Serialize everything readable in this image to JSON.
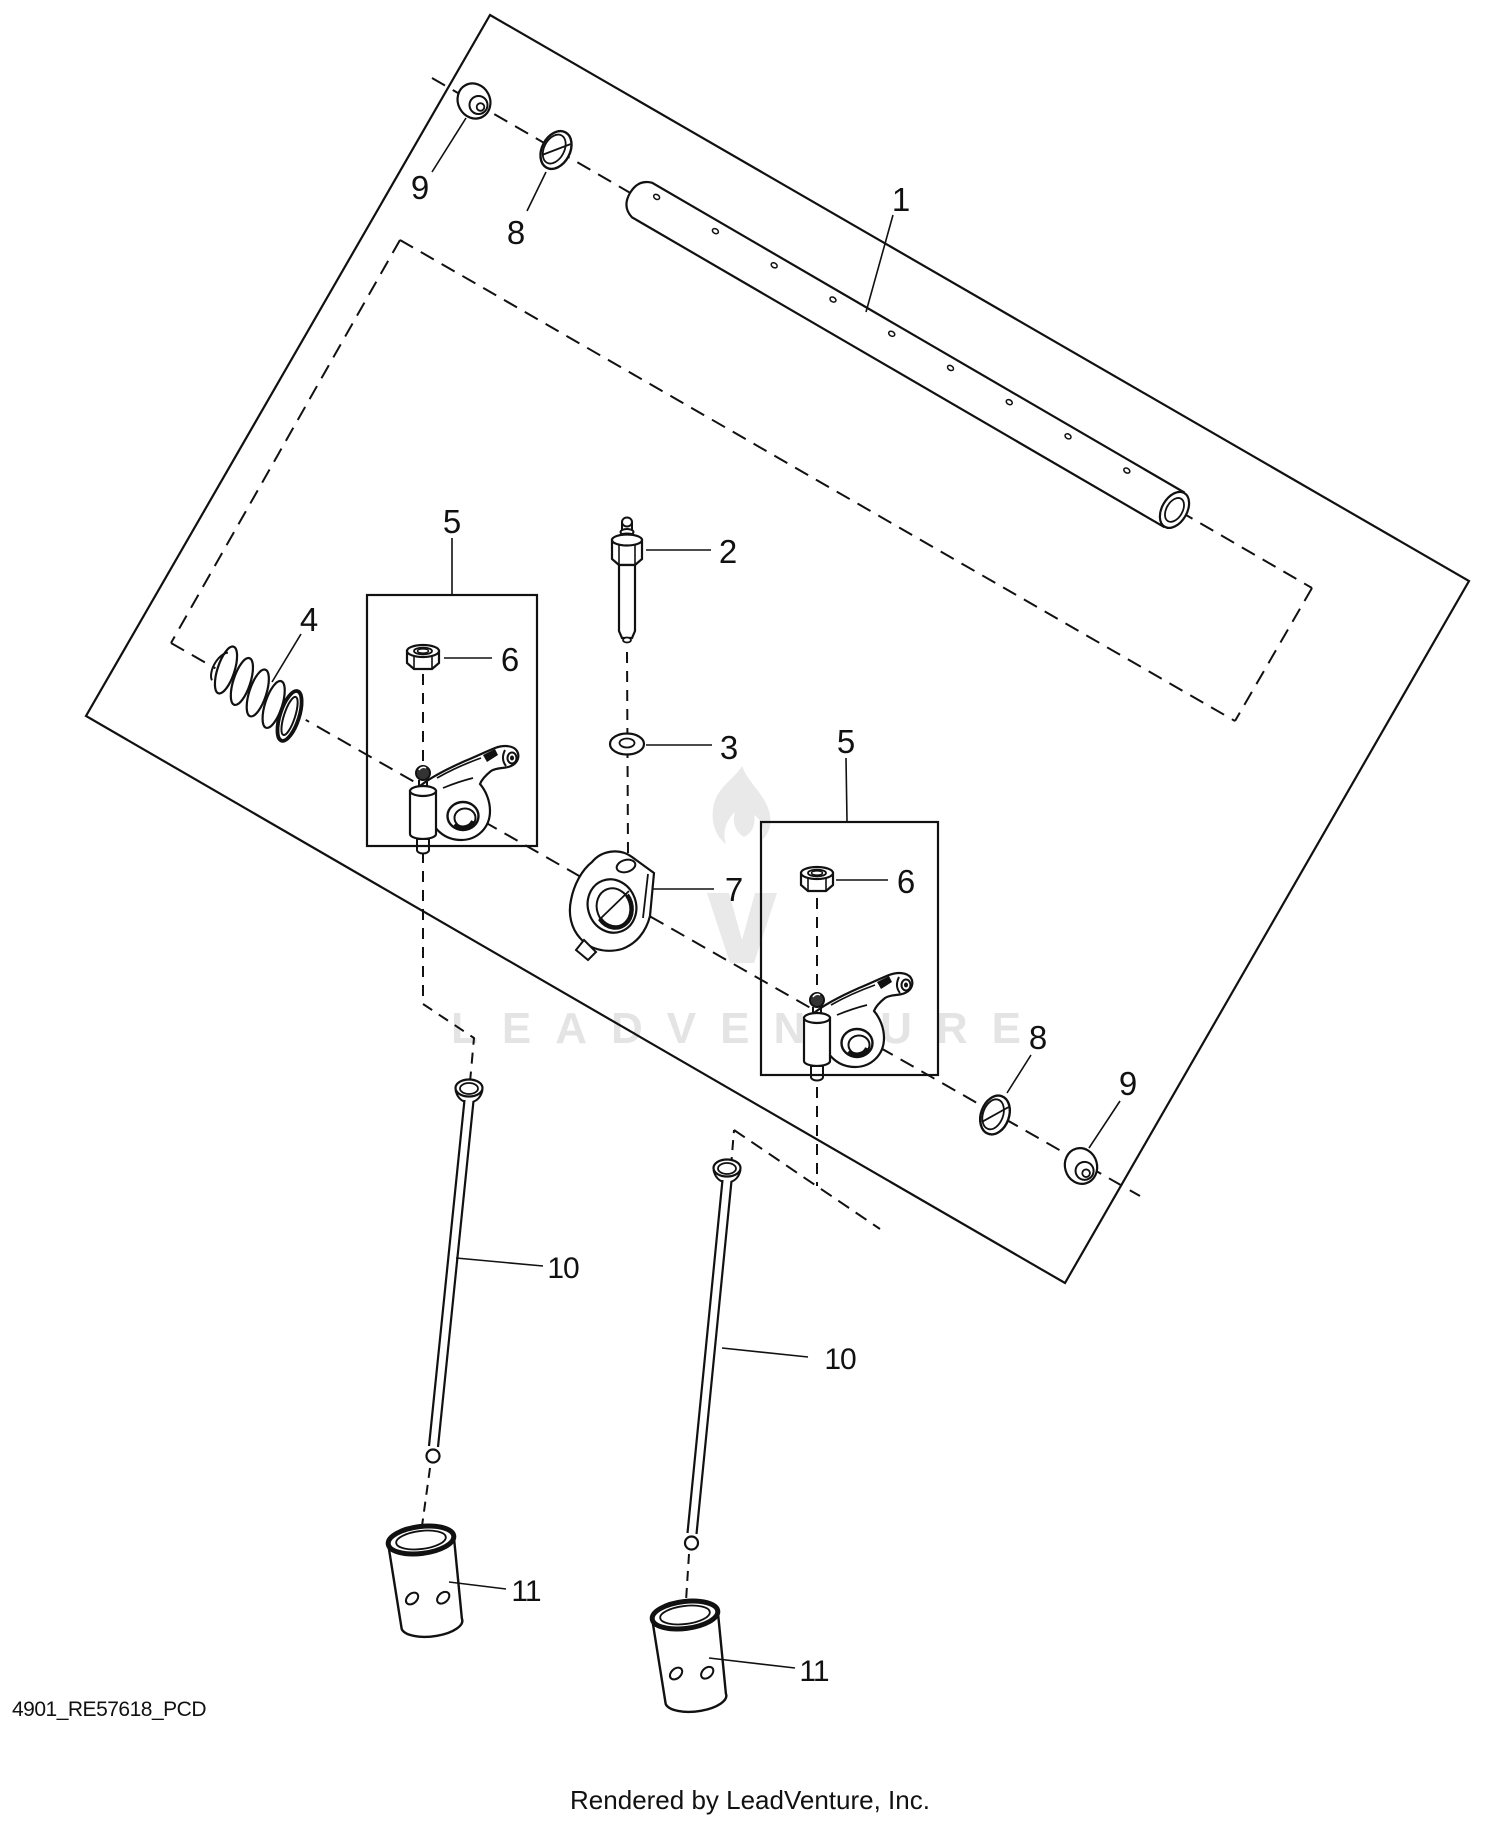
{
  "file_code": "4901_RE57618_PCD",
  "footer": "Rendered by LeadVenture, Inc.",
  "watermark": "LEADVENTURE",
  "line_color": "#111111",
  "watermark_color": "#e4e4e4",
  "callouts": [
    {
      "part": "rocker-arm-shaft",
      "text": "1"
    },
    {
      "part": "stud",
      "text": "2"
    },
    {
      "part": "washer-flat",
      "text": "3"
    },
    {
      "part": "spring",
      "text": "4"
    },
    {
      "part": "rocker-arm-assembly-left",
      "text": "5"
    },
    {
      "part": "rocker-arm-assembly-right",
      "text": "5"
    },
    {
      "part": "nut-left",
      "text": "6"
    },
    {
      "part": "nut-right",
      "text": "6"
    },
    {
      "part": "pivot-support",
      "text": "7"
    },
    {
      "part": "cup-washer-top",
      "text": "8"
    },
    {
      "part": "cup-washer-bottom",
      "text": "8"
    },
    {
      "part": "cap-top",
      "text": "9"
    },
    {
      "part": "cap-bottom",
      "text": "9"
    },
    {
      "part": "push-rod-left",
      "text": "10"
    },
    {
      "part": "push-rod-right",
      "text": "10"
    },
    {
      "part": "cam-follower-left",
      "text": "11"
    },
    {
      "part": "cam-follower-right",
      "text": "11"
    }
  ]
}
